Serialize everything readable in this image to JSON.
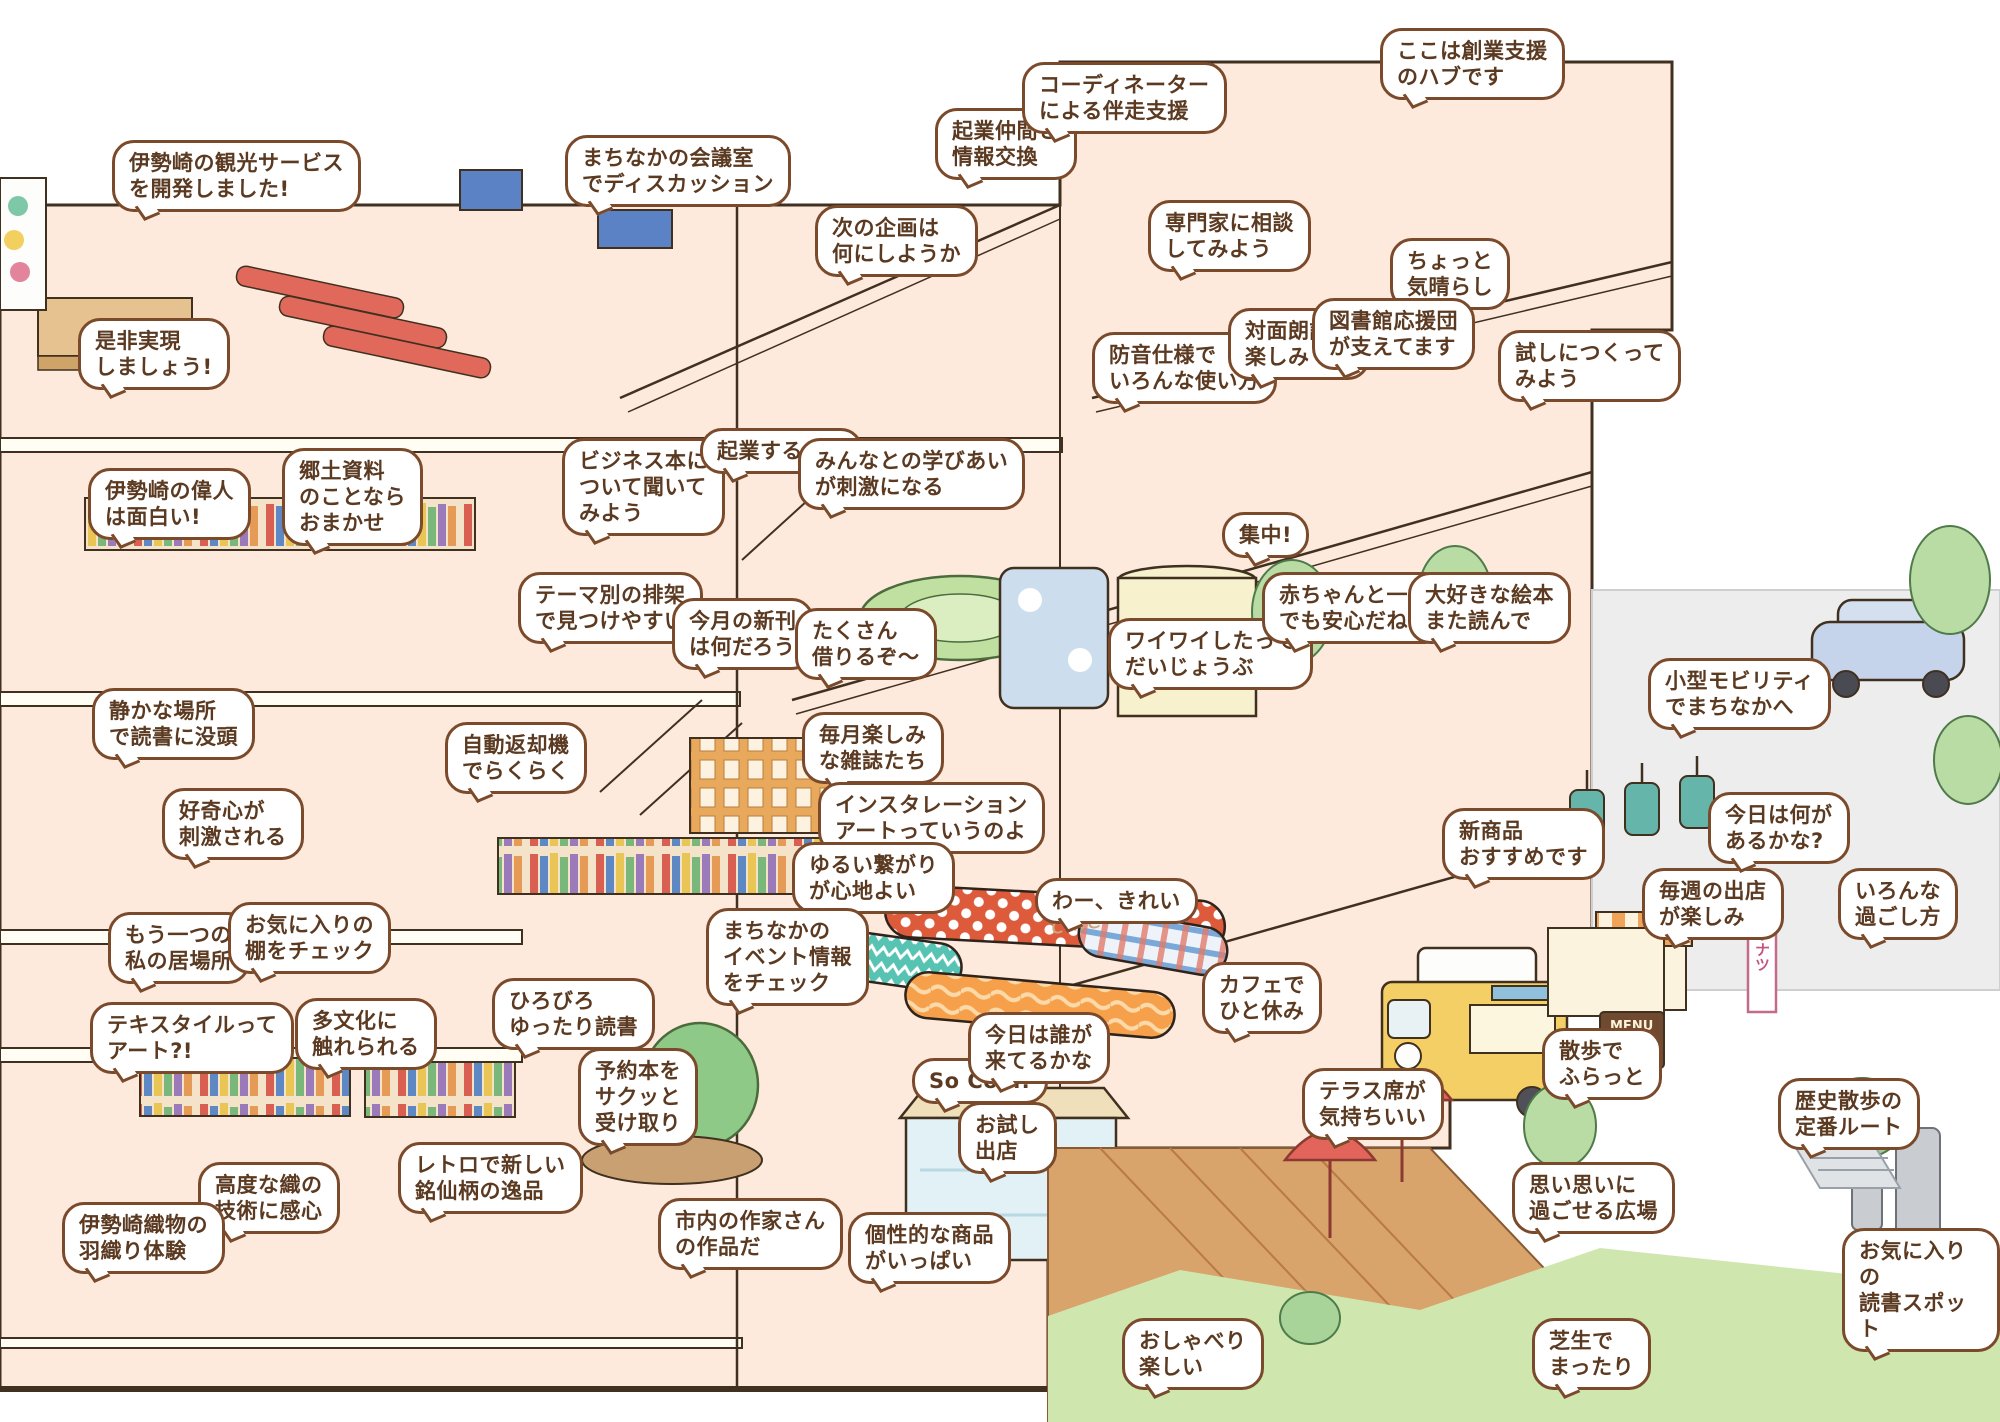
{
  "bubbles": [
    {
      "text": "伊勢崎の観光サービス\nを開発しました!"
    },
    {
      "text": "是非実現\nしましょう!"
    },
    {
      "text": "まちなかの会議室\nでディスカッション"
    },
    {
      "text": "起業仲間と\n情報交換"
    },
    {
      "text": "コーディネーター\nによる伴走支援"
    },
    {
      "text": "ここは創業支援\nのハブです"
    },
    {
      "text": "専門家に相談\nしてみよう"
    },
    {
      "text": "ちょっと\n気晴らし"
    },
    {
      "text": "次の企画は\n何にしようか"
    },
    {
      "text": "防音仕様で\nいろんな使い方"
    },
    {
      "text": "対面朗読が\n楽しみ"
    },
    {
      "text": "図書館応援団\nが支えてます"
    },
    {
      "text": "試しにつくって\nみよう"
    },
    {
      "text": "伊勢崎の偉人\nは面白い!"
    },
    {
      "text": "郷土資料\nのことなら\nおまかせ"
    },
    {
      "text": "ビジネス本に\nついて聞いて\nみよう"
    },
    {
      "text": "起業するぞ〜"
    },
    {
      "text": "みんなとの学びあい\nが刺激になる"
    },
    {
      "text": "テーマ別の排架\nで見つけやすい"
    },
    {
      "text": "今月の新刊\nは何だろう"
    },
    {
      "text": "たくさん\n借りるぞ〜"
    },
    {
      "text": "集中!"
    },
    {
      "text": "ワイワイしたって\nだいじょうぶ"
    },
    {
      "text": "赤ちゃんと一緒\nでも安心だね"
    },
    {
      "text": "大好きな絵本\nまた読んで"
    },
    {
      "text": "静かな場所\nで読書に没頭"
    },
    {
      "text": "好奇心が\n刺激される"
    },
    {
      "text": "自動返却機\nでらくらく"
    },
    {
      "text": "毎月楽しみ\nな雑誌たち"
    },
    {
      "text": "インスタレーション\nアートっていうのよ"
    },
    {
      "text": "ゆるい繋がり\nが心地よい"
    },
    {
      "text": "まちなかの\nイベント情報\nをチェック"
    },
    {
      "text": "わー、きれい"
    },
    {
      "text": "もう一つの\n私の居場所"
    },
    {
      "text": "お気に入りの\n棚をチェック"
    },
    {
      "text": "多文化に\n触れられる"
    },
    {
      "text": "ひろびろ\nゆったり読書"
    },
    {
      "text": "テキスタイルって\nアート?!"
    },
    {
      "text": "高度な織の\n技術に感心"
    },
    {
      "text": "伊勢崎織物の\n羽織り体験"
    },
    {
      "text": "レトロで新しい\n銘仙柄の逸品"
    },
    {
      "text": "予約本を\nサクッと\n受け取り"
    },
    {
      "text": "市内の作家さん\nの作品だ"
    },
    {
      "text": "個性的な商品\nがいっぱい"
    },
    {
      "text": "So Cool!"
    },
    {
      "text": "今日は誰が\n来てるかな"
    },
    {
      "text": "お試し\n出店"
    },
    {
      "text": "カフェで\nひと休み"
    },
    {
      "text": "テラス席が\n気持ちいい"
    },
    {
      "text": "散歩で\nふらっと"
    },
    {
      "text": "思い思いに\n過ごせる広場"
    },
    {
      "text": "芝生で\nまったり"
    },
    {
      "text": "おしゃべり\n楽しい"
    },
    {
      "text": "新商品\nおすすめです"
    },
    {
      "text": "毎週の出店\nが楽しみ"
    },
    {
      "text": "今日は何が\nあるかな?"
    },
    {
      "text": "いろんな\n過ごし方"
    },
    {
      "text": "小型モビリティ\nでまちなかへ"
    },
    {
      "text": "歴史散歩の\n定番ルート"
    },
    {
      "text": "お気に入りの\n読書スポット"
    }
  ],
  "signs": {
    "menu": "MENU",
    "donut_banner": "ドーナツ",
    "cafe_script": "cafe"
  },
  "palette": {
    "bubble_border": "#7b4a2b",
    "bubble_text": "#5b3a21",
    "floor_interior": "#fdeadd",
    "slab": "#fffdf4",
    "outline": "#40301f",
    "lawn": "#cfe7ae",
    "street": "#ededed",
    "deck": "#d9a36c",
    "truck_yellow": "#f4cf66",
    "umbrella_red": "#e2645a",
    "tree_green": "#b9dca4"
  }
}
